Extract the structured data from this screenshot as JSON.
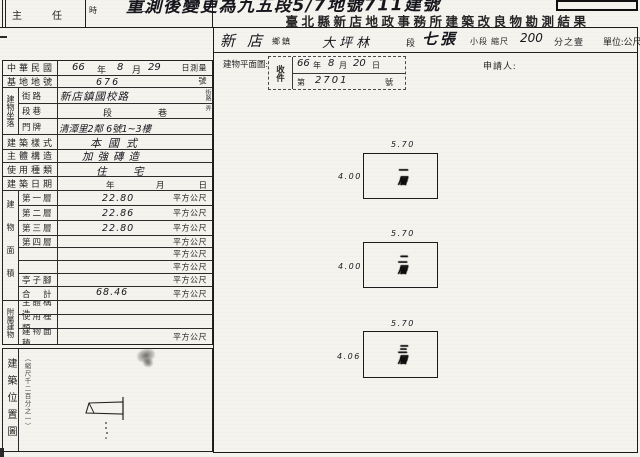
{
  "page": {
    "top_note": "重測後變更為九五段5/7地號711建號",
    "supervisor_label": "主　　　任",
    "time_label": "時",
    "dash_mark": "—",
    "title": "臺北縣新店地政事務所建築改良物勘測結果",
    "unit_label": "單位:公尺"
  },
  "location_row": {
    "township_value": "新店",
    "township_label": "鄉鎮",
    "section_value": "大坪林",
    "section_label": "段",
    "subsection_value": "七張",
    "subsection_label": "小段",
    "scale_label": "縮尺",
    "scale_value": "200",
    "scale_suffix": "分之壹"
  },
  "plan_header": {
    "label": "建物平面圖:",
    "applicant_label": "申請人:",
    "stamp": {
      "receive_item": "收件",
      "year": "66",
      "year_unit": "年",
      "month": "8",
      "month_unit": "月",
      "day": "20",
      "day_unit": "日",
      "number_prefix": "第",
      "number": "2701",
      "number_suffix": "號"
    }
  },
  "form": {
    "roc_row": {
      "label": "中華民國",
      "year": "66",
      "year_unit": "年",
      "month": "8",
      "month_unit": "月",
      "day": "29",
      "right": "日測量"
    },
    "lot_row": {
      "label": "基地地號",
      "value": "676",
      "right": "號"
    },
    "address": {
      "group": "建物坐落",
      "street_row": {
        "sub": "街路",
        "value": "新店鎮國校路",
        "right": "街路"
      },
      "lane_row": {
        "sub": "段巷",
        "mid1": "段",
        "mid2": "巷",
        "right": "弄"
      },
      "door_row": {
        "sub": "門牌",
        "value": "清潭里2鄰 6號1~3樓"
      }
    },
    "style_row": {
      "label": "建築樣式",
      "value": "本國式"
    },
    "structure_row": {
      "label": "主體構造",
      "value": "加強磚造"
    },
    "use_row": {
      "label": "使用種類",
      "value": "住　宅"
    },
    "date_row": {
      "label": "建築日期",
      "y": "年",
      "m": "月",
      "d": "日"
    },
    "area": {
      "group": "建物面積",
      "unit": "平方公尺",
      "rows": [
        {
          "sub": "第一層",
          "value": "22.80"
        },
        {
          "sub": "第二層",
          "value": "22.86"
        },
        {
          "sub": "第三層",
          "value": "22.80"
        },
        {
          "sub": "第四層",
          "value": ""
        },
        {
          "sub": "",
          "value": ""
        },
        {
          "sub": "",
          "value": ""
        },
        {
          "sub": "亭子腳",
          "value": ""
        },
        {
          "sub": "合　計",
          "value": "68.46"
        }
      ]
    },
    "annex": {
      "group": "附屬建物",
      "rows": [
        {
          "sub": "主體構造",
          "value": "",
          "unit": ""
        },
        {
          "sub": "使用種類",
          "value": "",
          "unit": ""
        },
        {
          "sub": "建物面積",
          "value": "",
          "unit": "平方公尺"
        }
      ]
    }
  },
  "site_map": {
    "label": "建築位置圖",
    "scale_note": "（縮尺千二百分之一）"
  },
  "floor_plans": [
    {
      "name": "一層",
      "top_dim": "5.70",
      "left_dim": "4.00"
    },
    {
      "name": "二層",
      "top_dim": "5.70",
      "left_dim": "4.00"
    },
    {
      "name": "三層",
      "top_dim": "5.70",
      "left_dim": "4.06"
    }
  ]
}
